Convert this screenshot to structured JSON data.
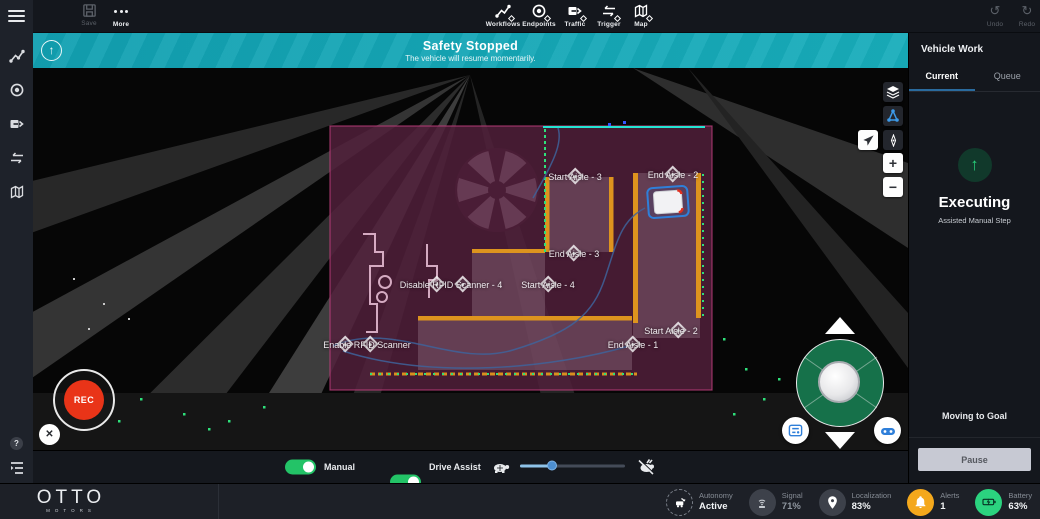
{
  "topbar": {
    "save_label": "Save",
    "more_label": "More",
    "tools": [
      {
        "label": "Workflows"
      },
      {
        "label": "Endpoints"
      },
      {
        "label": "Traffic"
      },
      {
        "label": "Trigger"
      },
      {
        "label": "Map"
      }
    ],
    "undo_label": "Undo",
    "redo_label": "Redo"
  },
  "banner": {
    "title": "Safety Stopped",
    "subtitle": "The vehicle will resume momentarily."
  },
  "map": {
    "waypoints": [
      {
        "label": "Start Aisle - 3",
        "x": 542,
        "y": 108,
        "markers": [
          0
        ]
      },
      {
        "label": "End Aisle - 2",
        "x": 640,
        "y": 106,
        "markers": [
          0
        ]
      },
      {
        "label": "End Aisle - 3",
        "x": 541,
        "y": 185,
        "markers": [
          0
        ]
      },
      {
        "label": "Disable RFID Scanner - 4",
        "x": 418,
        "y": 216,
        "markers": [
          -14,
          12
        ]
      },
      {
        "label": "Start Aisle - 4",
        "x": 515,
        "y": 216,
        "markers": [
          0
        ]
      },
      {
        "label": "Start Aisle - 2",
        "x": 638,
        "y": 262,
        "markers": [
          7
        ]
      },
      {
        "label": "End Aisle - 1",
        "x": 600,
        "y": 276,
        "markers": [
          0
        ]
      },
      {
        "label": "Enable RFID Scanner",
        "x": 334,
        "y": 276,
        "markers": [
          -22,
          3
        ]
      }
    ],
    "rec_label": "REC"
  },
  "glyphs": {
    "up_arrow": "↑",
    "undo": "↺",
    "redo": "↻",
    "zoom_in": "+",
    "zoom_out": "−",
    "close": "✕",
    "help": "?"
  },
  "controls": {
    "manual_label": "Manual",
    "drive_assist_label": "Drive Assist"
  },
  "vehicle_work": {
    "title": "Vehicle Work",
    "tabs": [
      {
        "label": "Current",
        "active": true
      },
      {
        "label": "Queue",
        "active": false
      }
    ],
    "status_title": "Executing",
    "status_subtitle": "Assisted Manual Step",
    "action_text": "Moving to Goal",
    "pause_label": "Pause"
  },
  "statusbar": {
    "brand": "OTTO",
    "brand_sub": "MOTORS",
    "items": [
      {
        "label": "Autonomy",
        "value": "Active"
      },
      {
        "label": "Signal",
        "value": "71%"
      },
      {
        "label": "Localization",
        "value": "83%"
      },
      {
        "label": "Alerts",
        "value": "1"
      },
      {
        "label": "Battery",
        "value": "63%"
      }
    ]
  },
  "colors": {
    "banner_teal": "#16a5b4",
    "toggle_green": "#23c367",
    "joystick_green": "#16714a",
    "rec_red": "#e93418",
    "alert_orange": "#f4a81c",
    "battery_green": "#2bd37f",
    "map_zone_purple": "#52203c",
    "rack_orange": "#dd941e",
    "edge_cyan": "#25e3d2",
    "edge_green": "#2ee07a",
    "path_blue": "#3f639b",
    "tab_underline": "#2a6b9e"
  }
}
